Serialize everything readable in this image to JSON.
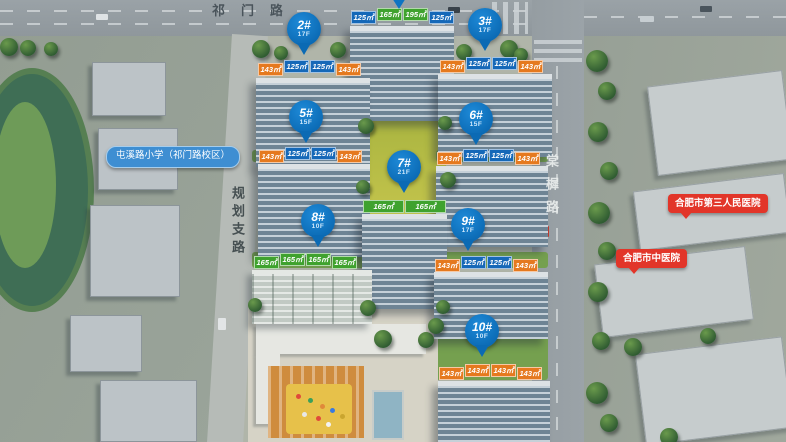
{
  "roads": {
    "top": {
      "label": "祁门路"
    },
    "left": {
      "label": "规划支路"
    },
    "right": {
      "label": "棠樨路"
    }
  },
  "pois": {
    "school": {
      "label": "屯溪路小学（祁门路校区）"
    },
    "hospital_third": {
      "label": "合肥市第三人民医院"
    },
    "hospital_tcm": {
      "label": "合肥市中医院"
    }
  },
  "buildings": [
    {
      "name": "north-tower",
      "pin": null,
      "areas": [
        {
          "text": "125㎡",
          "type": "blue"
        },
        {
          "text": "165㎡",
          "type": "green"
        },
        {
          "text": "195㎡",
          "type": "green"
        },
        {
          "text": "125㎡",
          "type": "blue"
        }
      ]
    },
    {
      "name": "building-2",
      "pin": {
        "no": "2#",
        "floors": "17F"
      },
      "areas": [
        {
          "text": "143㎡",
          "type": "orange"
        },
        {
          "text": "125㎡",
          "type": "blue"
        },
        {
          "text": "125㎡",
          "type": "blue"
        },
        {
          "text": "143㎡",
          "type": "orange"
        }
      ]
    },
    {
      "name": "building-3",
      "pin": {
        "no": "3#",
        "floors": "17F"
      },
      "areas": [
        {
          "text": "143㎡",
          "type": "orange"
        },
        {
          "text": "125㎡",
          "type": "blue"
        },
        {
          "text": "125㎡",
          "type": "blue"
        },
        {
          "text": "143㎡",
          "type": "orange"
        }
      ]
    },
    {
      "name": "building-5",
      "pin": {
        "no": "5#",
        "floors": "15F"
      },
      "areas": [
        {
          "text": "143㎡",
          "type": "orange"
        },
        {
          "text": "125㎡",
          "type": "blue"
        },
        {
          "text": "125㎡",
          "type": "blue"
        },
        {
          "text": "143㎡",
          "type": "orange"
        }
      ]
    },
    {
      "name": "building-6",
      "pin": {
        "no": "6#",
        "floors": "15F"
      },
      "areas": [
        {
          "text": "143㎡",
          "type": "orange"
        },
        {
          "text": "125㎡",
          "type": "blue"
        },
        {
          "text": "125㎡",
          "type": "blue"
        },
        {
          "text": "143㎡",
          "type": "orange"
        }
      ]
    },
    {
      "name": "building-7",
      "pin": {
        "no": "7#",
        "floors": "21F"
      },
      "areas": [
        {
          "text": "165㎡",
          "type": "green"
        },
        {
          "text": "165㎡",
          "type": "green"
        }
      ]
    },
    {
      "name": "building-8",
      "pin": {
        "no": "8#",
        "floors": "10F"
      },
      "areas": [
        {
          "text": "165㎡",
          "type": "green"
        },
        {
          "text": "165㎡",
          "type": "green"
        },
        {
          "text": "165㎡",
          "type": "green"
        },
        {
          "text": "165㎡",
          "type": "green"
        }
      ]
    },
    {
      "name": "building-9",
      "pin": {
        "no": "9#",
        "floors": "17F"
      },
      "areas": [
        {
          "text": "143㎡",
          "type": "orange"
        },
        {
          "text": "125㎡",
          "type": "blue"
        },
        {
          "text": "125㎡",
          "type": "blue"
        },
        {
          "text": "143㎡",
          "type": "orange"
        }
      ]
    },
    {
      "name": "building-10",
      "pin": {
        "no": "10#",
        "floors": "10F"
      },
      "areas": [
        {
          "text": "143㎡",
          "type": "orange"
        },
        {
          "text": "143㎡",
          "type": "orange"
        },
        {
          "text": "143㎡",
          "type": "orange"
        },
        {
          "text": "143㎡",
          "type": "orange"
        }
      ]
    }
  ],
  "colors": {
    "pin_blue": "#0b6ab4",
    "area_orange": "#e5791e",
    "area_blue": "#1568b8",
    "area_green": "#3fa22e",
    "poi_red": "#e23529",
    "poi_school_blue": "#3e8ed2"
  }
}
